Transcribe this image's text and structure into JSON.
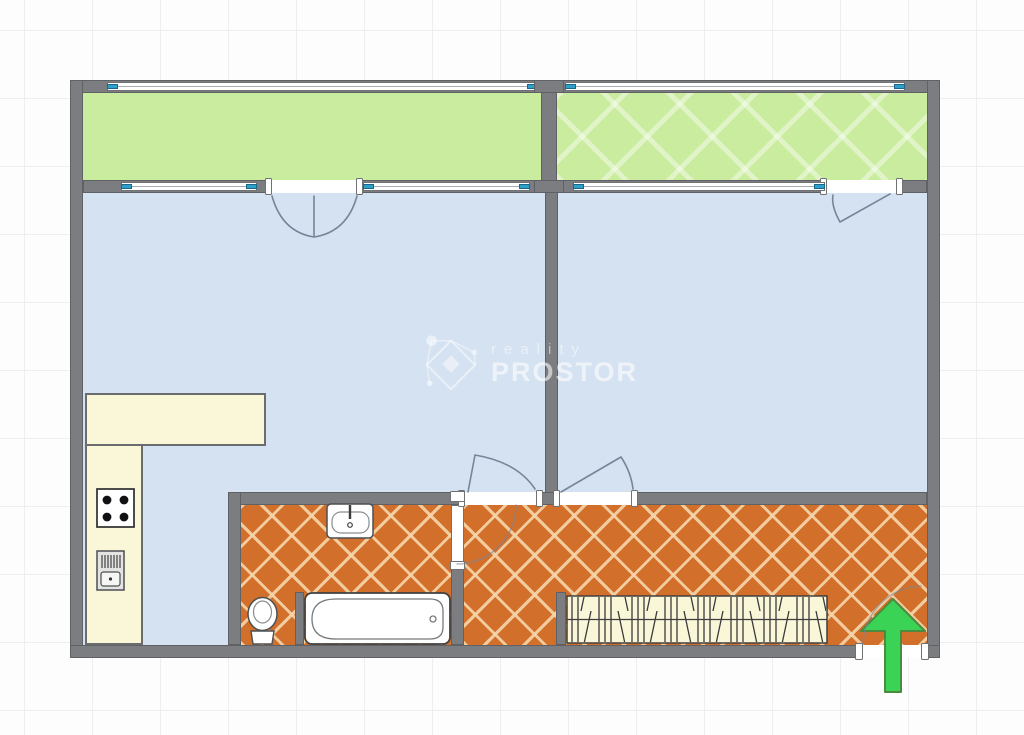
{
  "watermark": {
    "line1": "reality",
    "line2": "PROSTOR"
  },
  "colors": {
    "bg": "#fdfdfe",
    "grid": "#ededf2",
    "wall": "#7b7d80",
    "room": "#d5e2f1",
    "balcony": "#c9ec9f",
    "tile": "#d2702b",
    "tileline": "rgba(245,214,170,0.9)",
    "counter": "#faf6d8",
    "glass": "#2f9fc7",
    "arrow": "#3bd355",
    "arrowedge": "#4c8a3f",
    "arc": "#76859a",
    "fixture": "#4d4f52"
  },
  "plan": {
    "rects": [
      {
        "name": "balcony-left-floor",
        "cls": "balcony",
        "x": 83,
        "y": 93,
        "w": 458,
        "h": 87
      },
      {
        "name": "balcony-right-floor",
        "cls": "balcony hatch",
        "x": 557,
        "y": 93,
        "w": 370,
        "h": 87
      },
      {
        "name": "living-room-floor",
        "cls": "room",
        "x": 83,
        "y": 193,
        "w": 462,
        "h": 452
      },
      {
        "name": "bedroom-floor",
        "cls": "room",
        "x": 558,
        "y": 193,
        "w": 369,
        "h": 299
      },
      {
        "name": "bathroom-floor",
        "cls": "tiles",
        "x": 241,
        "y": 505,
        "w": 210,
        "h": 140
      },
      {
        "name": "hallway-floor",
        "cls": "tiles",
        "x": 464,
        "y": 505,
        "w": 463,
        "h": 140
      },
      {
        "name": "kitchen-counter-top",
        "cls": "counter",
        "x": 85,
        "y": 393,
        "w": 181,
        "h": 53
      },
      {
        "name": "kitchen-counter-side",
        "cls": "counter",
        "x": 85,
        "y": 444,
        "w": 58,
        "h": 201
      },
      {
        "name": "wall-top",
        "cls": "wall",
        "x": 70,
        "y": 80,
        "w": 870,
        "h": 13
      },
      {
        "name": "wall-left",
        "cls": "wall",
        "x": 70,
        "y": 80,
        "w": 13,
        "h": 578
      },
      {
        "name": "wall-right",
        "cls": "wall",
        "x": 927,
        "y": 80,
        "w": 13,
        "h": 578
      },
      {
        "name": "wall-bottom-left",
        "cls": "wall",
        "x": 70,
        "y": 645,
        "w": 792,
        "h": 13
      },
      {
        "name": "wall-bottom-right",
        "cls": "wall",
        "x": 923,
        "y": 645,
        "w": 17,
        "h": 13
      },
      {
        "name": "wall-balcony-divider",
        "cls": "wall",
        "x": 541,
        "y": 80,
        "w": 16,
        "h": 113
      },
      {
        "name": "wall-room-divider",
        "cls": "wall",
        "x": 545,
        "y": 180,
        "w": 13,
        "h": 325
      },
      {
        "name": "wall-balcony-front",
        "cls": "wall",
        "x": 83,
        "y": 180,
        "w": 844,
        "h": 13
      },
      {
        "name": "wall-hall-top",
        "cls": "wall",
        "x": 228,
        "y": 492,
        "w": 699,
        "h": 13
      },
      {
        "name": "wall-bathroom-left",
        "cls": "wall",
        "x": 228,
        "y": 492,
        "w": 13,
        "h": 153
      },
      {
        "name": "wall-bathroom-right-stub",
        "cls": "wall",
        "x": 451,
        "y": 567,
        "w": 13,
        "h": 78
      },
      {
        "name": "wall-tub-stub",
        "cls": "wall",
        "x": 295,
        "y": 592,
        "w": 9,
        "h": 53
      },
      {
        "name": "wall-wardrobe-stub",
        "cls": "wall",
        "x": 556,
        "y": 592,
        "w": 10,
        "h": 53
      },
      {
        "name": "balcony-door-opening-left",
        "cls": "opening",
        "x": 272,
        "y": 180,
        "w": 85,
        "h": 13
      },
      {
        "name": "balcony-door-opening-right",
        "cls": "opening",
        "x": 827,
        "y": 180,
        "w": 70,
        "h": 13
      },
      {
        "name": "living-room-door-opening",
        "cls": "opening",
        "x": 465,
        "y": 492,
        "w": 71,
        "h": 13
      },
      {
        "name": "bedroom-door-opening",
        "cls": "opening",
        "x": 560,
        "y": 492,
        "w": 71,
        "h": 13
      },
      {
        "name": "entrance-door-opening",
        "cls": "opening",
        "x": 862,
        "y": 645,
        "w": 61,
        "h": 13
      },
      {
        "name": "bathroom-door-leaf",
        "cls": "leaf",
        "x": 451,
        "y": 505,
        "w": 13,
        "h": 62
      },
      {
        "name": "door-post",
        "cls": "post",
        "x": 265,
        "y": 178,
        "w": 7,
        "h": 17
      },
      {
        "name": "door-post",
        "cls": "post",
        "x": 356,
        "y": 178,
        "w": 7,
        "h": 17
      },
      {
        "name": "door-post",
        "cls": "post",
        "x": 820,
        "y": 178,
        "w": 7,
        "h": 17
      },
      {
        "name": "door-post",
        "cls": "post",
        "x": 896,
        "y": 178,
        "w": 7,
        "h": 17
      },
      {
        "name": "door-post",
        "cls": "post",
        "x": 458,
        "y": 490,
        "w": 7,
        "h": 17
      },
      {
        "name": "door-post",
        "cls": "post",
        "x": 536,
        "y": 490,
        "w": 7,
        "h": 17
      },
      {
        "name": "door-post",
        "cls": "post",
        "x": 553,
        "y": 490,
        "w": 7,
        "h": 17
      },
      {
        "name": "door-post",
        "cls": "post",
        "x": 631,
        "y": 490,
        "w": 7,
        "h": 17
      },
      {
        "name": "door-post",
        "cls": "post",
        "x": 855,
        "y": 643,
        "w": 8,
        "h": 17
      },
      {
        "name": "door-post",
        "cls": "post",
        "x": 921,
        "y": 643,
        "w": 8,
        "h": 17
      },
      {
        "name": "door-post",
        "cls": "post",
        "x": 450,
        "y": 491,
        "w": 15,
        "h": 11
      },
      {
        "name": "door-post",
        "cls": "post",
        "x": 450,
        "y": 561,
        "w": 15,
        "h": 9
      }
    ],
    "rects2": [
      {
        "name": "balcony-divider-cap-top",
        "cls": "wall",
        "x": 534,
        "y": 80,
        "w": 30,
        "h": 13
      },
      {
        "name": "balcony-divider-cap-bottom",
        "cls": "wall",
        "x": 534,
        "y": 180,
        "w": 30,
        "h": 13
      }
    ],
    "windows": [
      {
        "name": "window-balcony-left-outer",
        "x": 107,
        "y": 82,
        "w": 431
      },
      {
        "name": "window-balcony-right-outer",
        "x": 565,
        "y": 82,
        "w": 340
      },
      {
        "name": "window-living-room-left",
        "x": 121,
        "y": 182,
        "w": 136
      },
      {
        "name": "window-living-room-right",
        "x": 363,
        "y": 182,
        "w": 167
      },
      {
        "name": "window-bedroom",
        "x": 573,
        "y": 182,
        "w": 252
      }
    ],
    "door_arcs": [
      {
        "name": "balcony-french-door-swing",
        "d": "M272,196 Q282,232 314,237 M357,196 Q347,232 314,237 M314,196 L314,237"
      },
      {
        "name": "balcony-right-door-swing",
        "d": "M890,194 L840,222 M840,222 Q831,206 833,195"
      },
      {
        "name": "living-room-door-swing",
        "d": "M468,492 L475,455 M475,455 Q517,462 535,489"
      },
      {
        "name": "bedroom-door-swing",
        "d": "M561,492 L621,457 M621,457 Q631,472 633,489"
      },
      {
        "name": "bathroom-door-swing",
        "d": "M516,505 A59,59 0 0 1 457,564",
        "faint": true
      },
      {
        "name": "entrance-door-swing",
        "d": "M863,644 A60,60 0 0 1 921,586",
        "faint": true
      }
    ]
  }
}
